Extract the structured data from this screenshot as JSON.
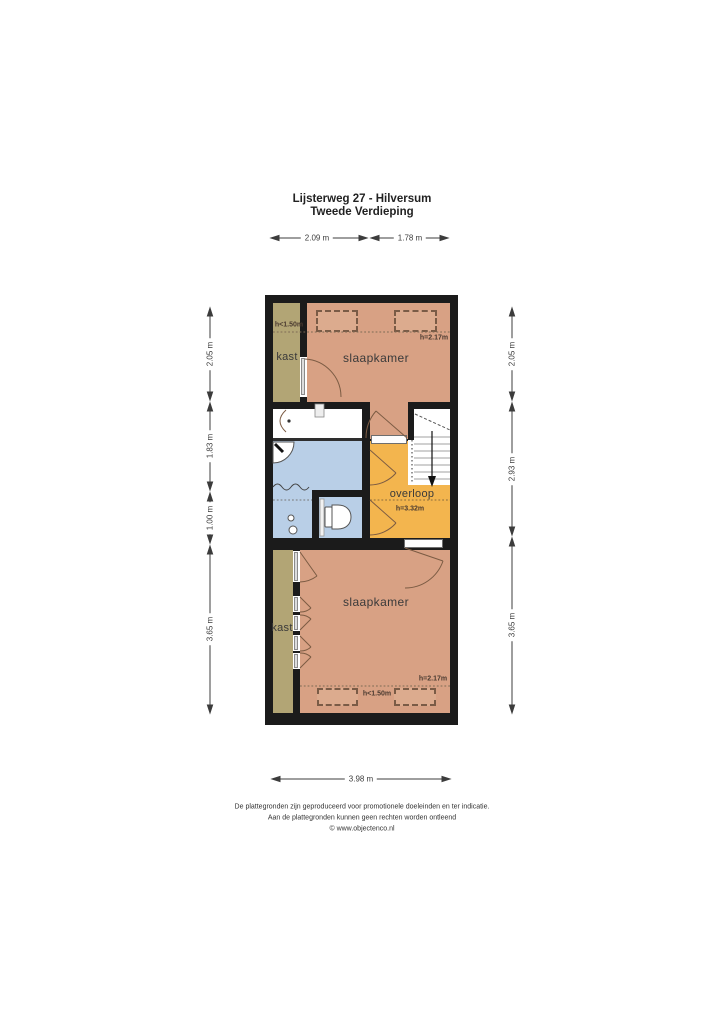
{
  "meta": {
    "title_line1": "Lijsterweg 27 - Hilversum",
    "title_line2": "Tweede Verdieping"
  },
  "rooms": {
    "kast_top": {
      "label": "kast"
    },
    "slaapkamer_top": {
      "label": "slaapkamer",
      "h_low": "h<1.50m",
      "h_high": "h=2.17m"
    },
    "overloop": {
      "label": "overloop",
      "h": "h=3.32m"
    },
    "kast_bottom": {
      "label": "kast"
    },
    "slaapkamer_bottom": {
      "label": "slaapkamer",
      "h_low": "h<1.50m",
      "h_high": "h=2.17m"
    }
  },
  "dimensions": {
    "top": [
      "2.09 m",
      "1.78 m"
    ],
    "bottom": "3.98 m",
    "left": [
      "2.05 m",
      "1.83 m",
      "1.00 m",
      "3.65 m"
    ],
    "right": [
      "2.05 m",
      "2.93 m",
      "3.65 m"
    ]
  },
  "footer": {
    "line1": "De plattegronden zijn geproduceerd voor promotionele doeleinden en ter indicatie.",
    "line2": "Aan de plattegronden kunnen geen rechten worden ontleend",
    "line3": "© www.objectenco.nl"
  },
  "colors": {
    "wall": "#1b1b1b",
    "bedroom": "#d8a184",
    "closet": "#b2a575",
    "bathroom": "#b9cfe7",
    "landing": "#f3b54e",
    "label": "#3a3a3a",
    "dimension": "#3c3c3c"
  }
}
